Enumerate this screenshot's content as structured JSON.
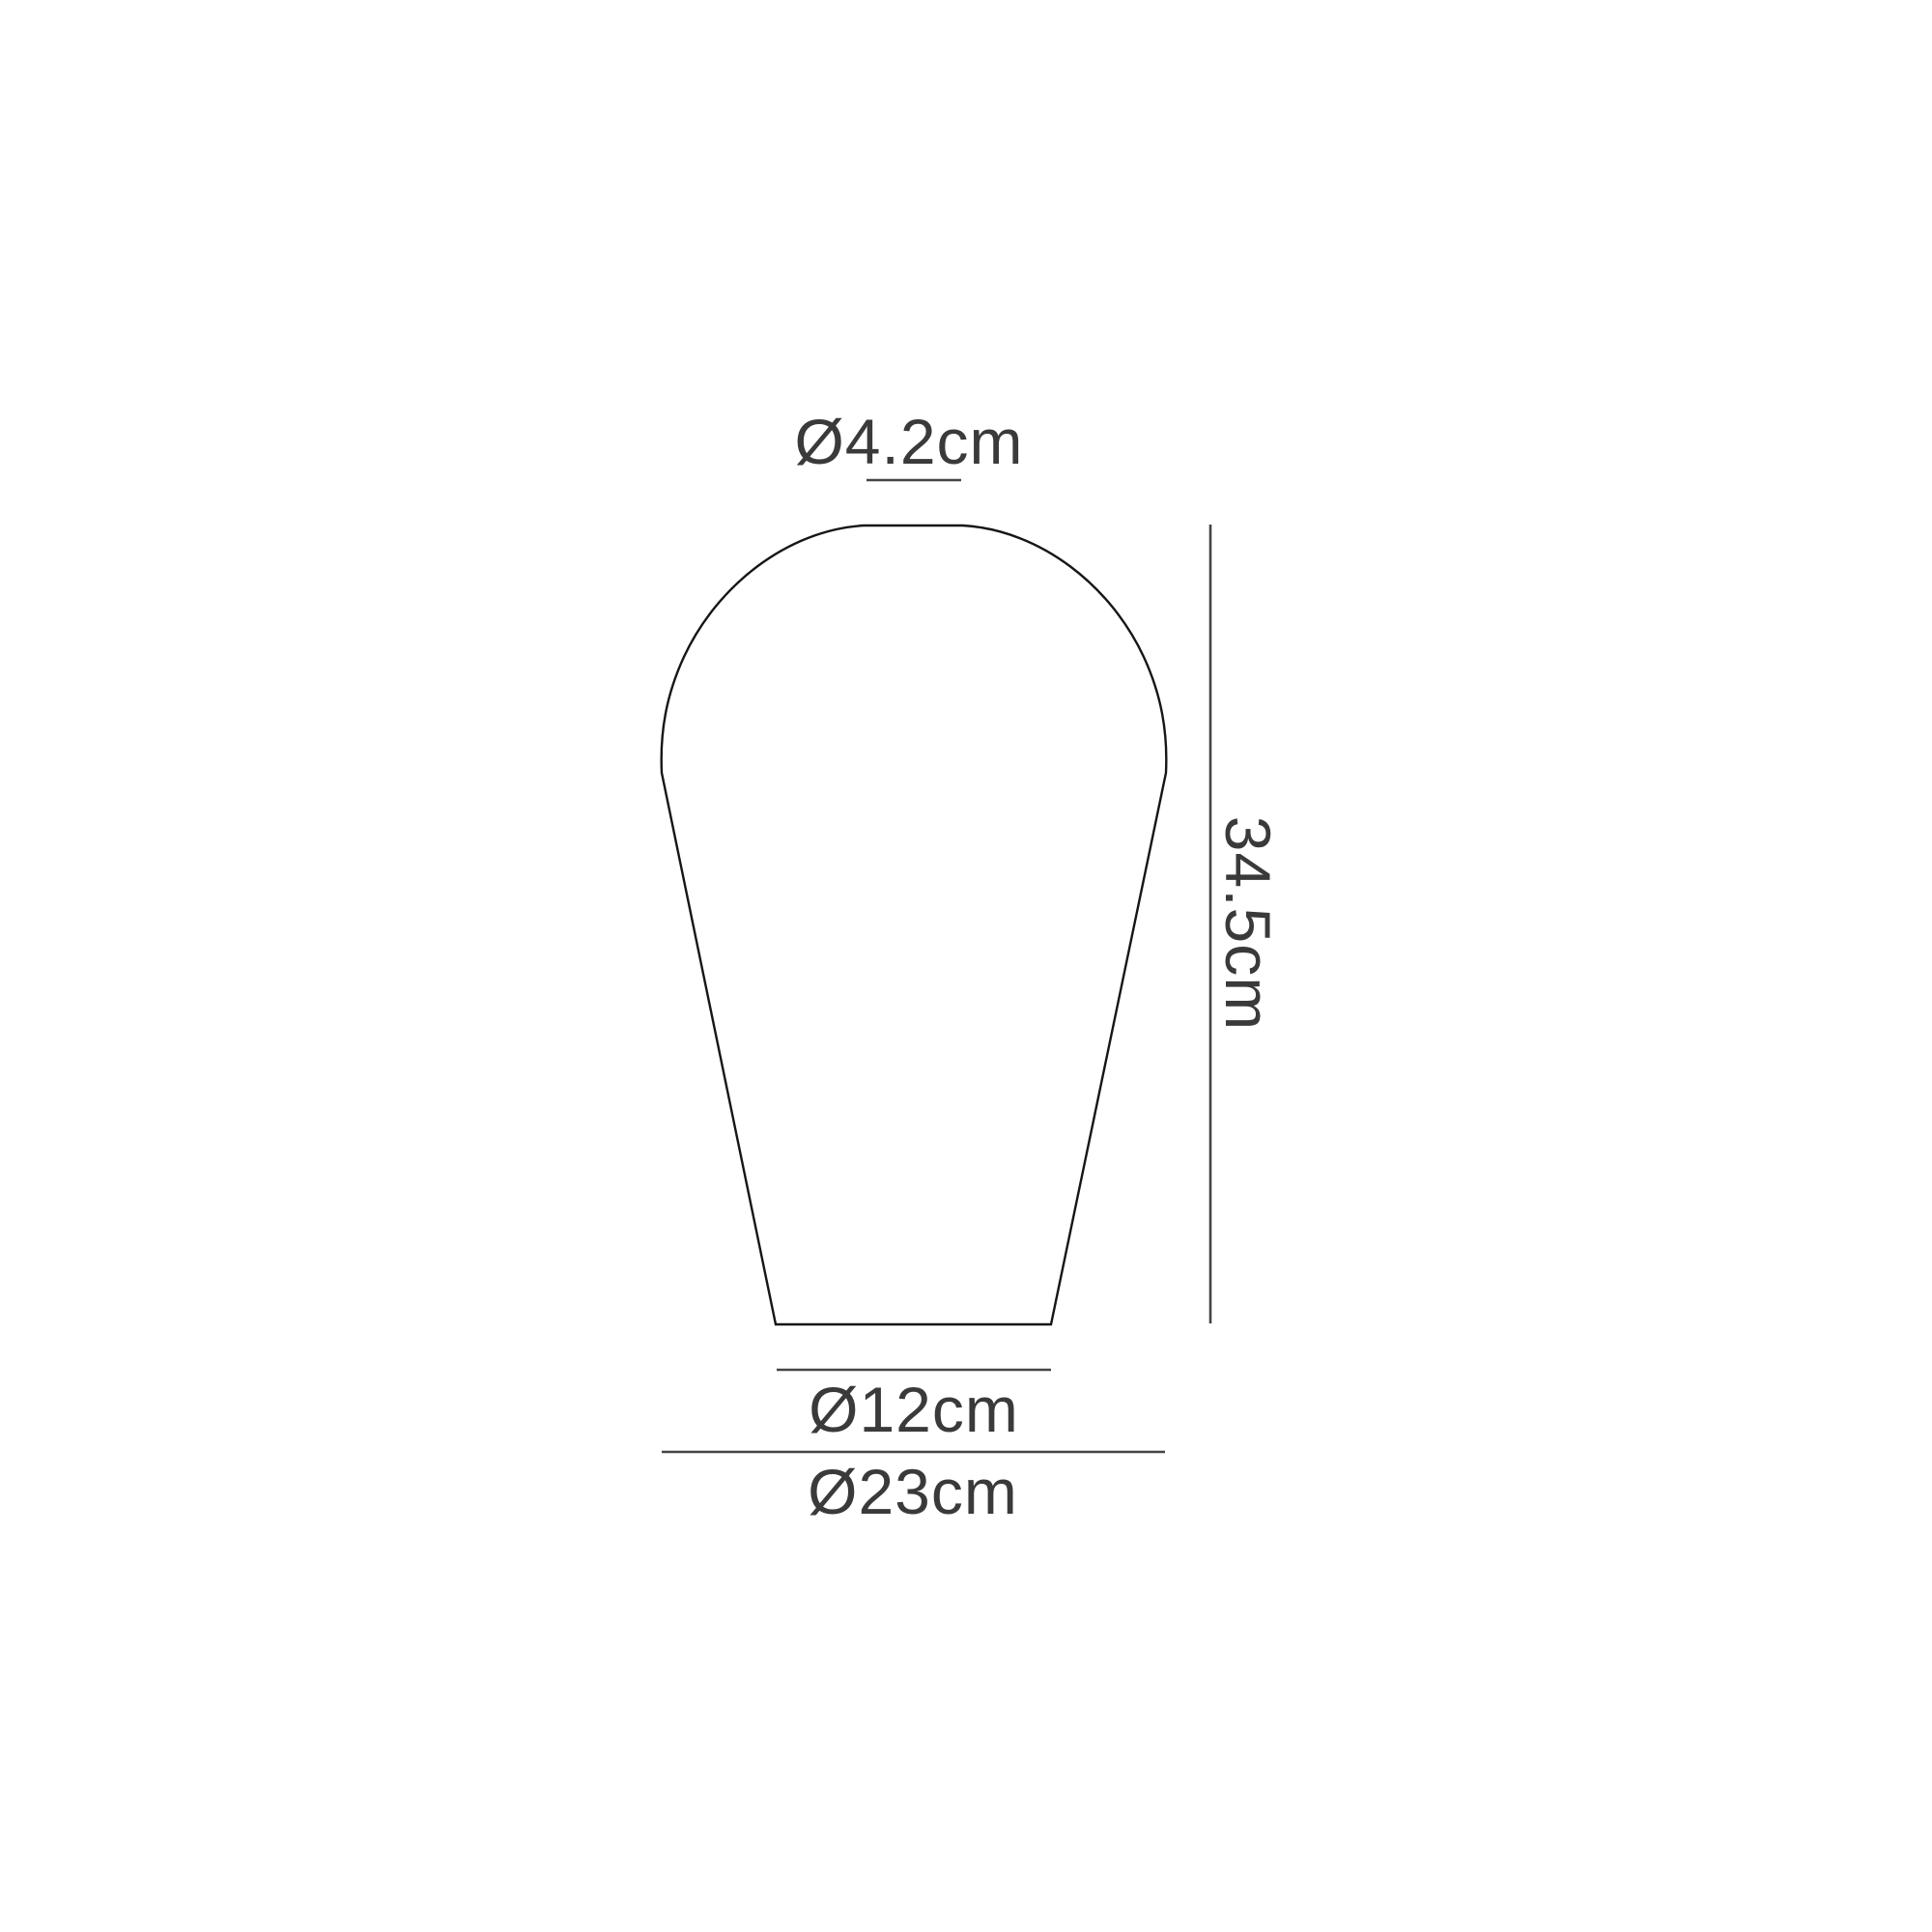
{
  "page": {
    "background_color": "#ffffff"
  },
  "diagram": {
    "kind": "technical-dimension-drawing",
    "subject": "pear-shaped lampshade / bulb glass outline, front elevation",
    "colors": {
      "outline": "#161616",
      "dimension_lines": "#454545",
      "text": "#3a3a3a"
    },
    "dimensions": {
      "top_diameter": {
        "label": "Ø4.2cm",
        "value_cm": 4.2,
        "position": "above shape, top opening"
      },
      "height": {
        "label": "34.5cm",
        "value_cm": 34.5,
        "position": "right side, vertical, rotated 90°"
      },
      "base_diameter": {
        "label": "Ø12cm",
        "value_cm": 12,
        "position": "below shape, bottom opening"
      },
      "max_diameter": {
        "label": "Ø23cm",
        "value_cm": 23,
        "position": "bottom, widest diameter"
      }
    }
  }
}
